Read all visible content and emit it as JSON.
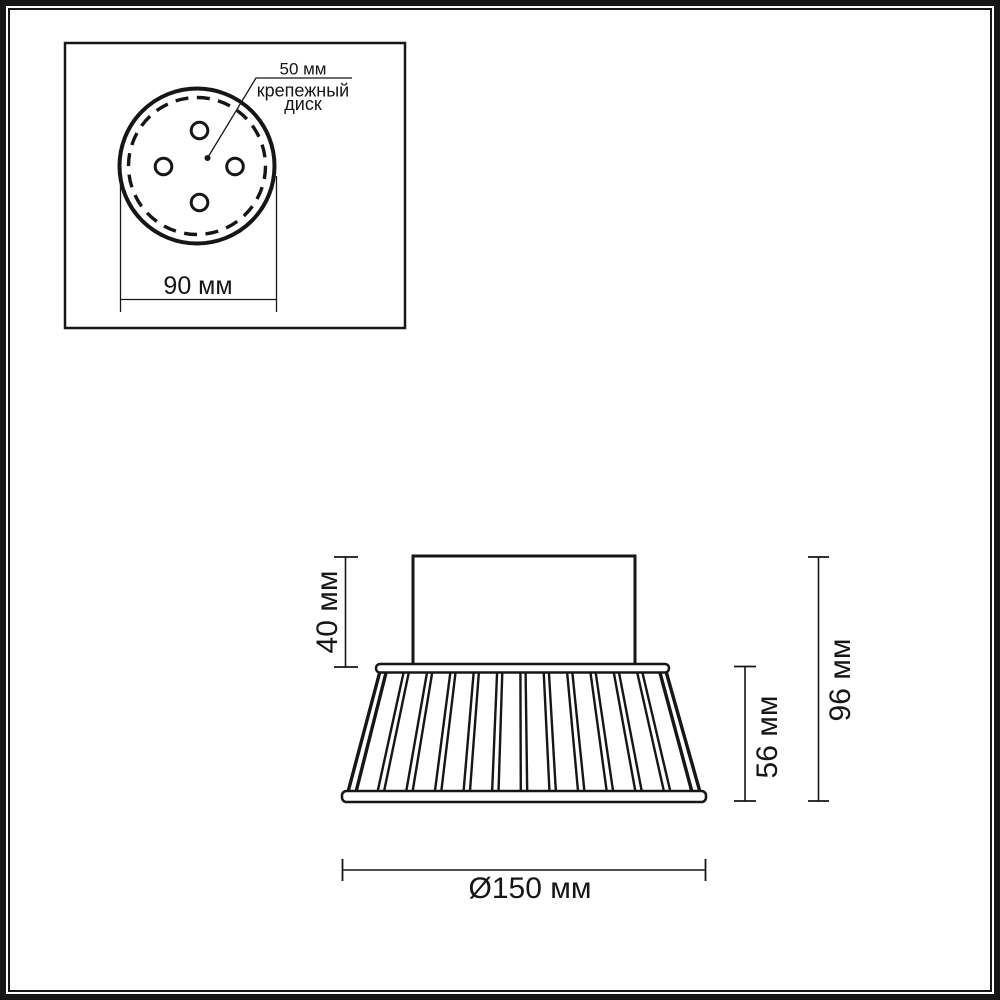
{
  "page": {
    "bg_color": "#ffffff",
    "ink_color": "#161616"
  },
  "inset": {
    "callout": {
      "value": "50 мм",
      "label_lines": [
        "крепежный",
        "диск"
      ]
    },
    "width_dim": {
      "label": "90 мм"
    },
    "hole_count": 4
  },
  "main": {
    "mount_height_dim": {
      "label": "40 мм"
    },
    "shade_height_dim": {
      "label": "56 мм"
    },
    "total_height_dim": {
      "label": "96 мм"
    },
    "diameter_dim": {
      "label": "Ø150 мм"
    }
  }
}
